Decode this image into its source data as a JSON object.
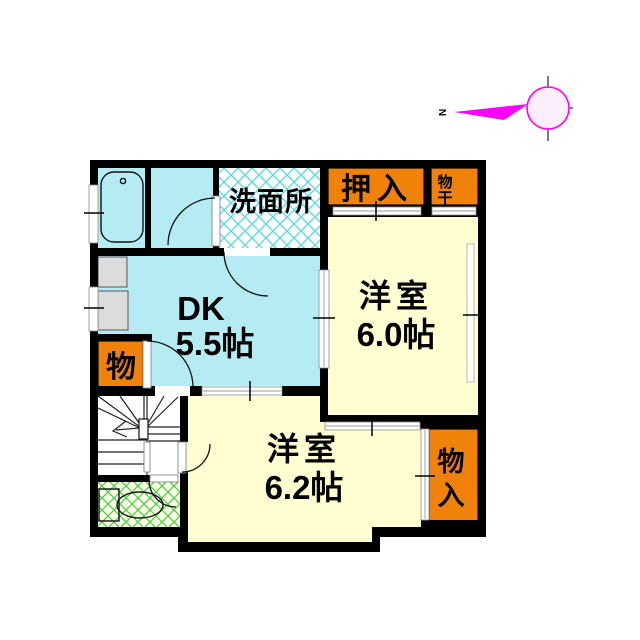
{
  "document": {
    "kind": "apartment-floor-plan"
  },
  "colors": {
    "wall": "#000000",
    "room_cyan": "#b5ecf3",
    "room_yellow": "#ffffd2",
    "closet_orange": "#f0820a",
    "hall_pink": "#f8c6c6",
    "lattice_cyan": "#5fd9e2",
    "lattice_green": "#44cc44",
    "fixture_gray": "#dcdcdc",
    "toilet_floor": "#fdfde6",
    "compass_magenta": "#ff00ff",
    "compass_circle_fill": "#feeffe",
    "north_red": "#ee1111"
  },
  "rooms": {
    "washroom": {
      "label": "洗面所"
    },
    "oshiire": {
      "label": "押入"
    },
    "monohoshi": {
      "chars": [
        "物",
        "干"
      ]
    },
    "western_room_60": {
      "label": "洋室",
      "size": "6.0帖"
    },
    "dk": {
      "label": "DK",
      "size": "5.5帖"
    },
    "storage_left": {
      "label": "物"
    },
    "western_room_62": {
      "label": "洋室",
      "size": "6.2帖"
    },
    "storage_bottom_right": {
      "chars": [
        "物",
        "入"
      ]
    }
  },
  "compass": {
    "north_label": "N"
  }
}
